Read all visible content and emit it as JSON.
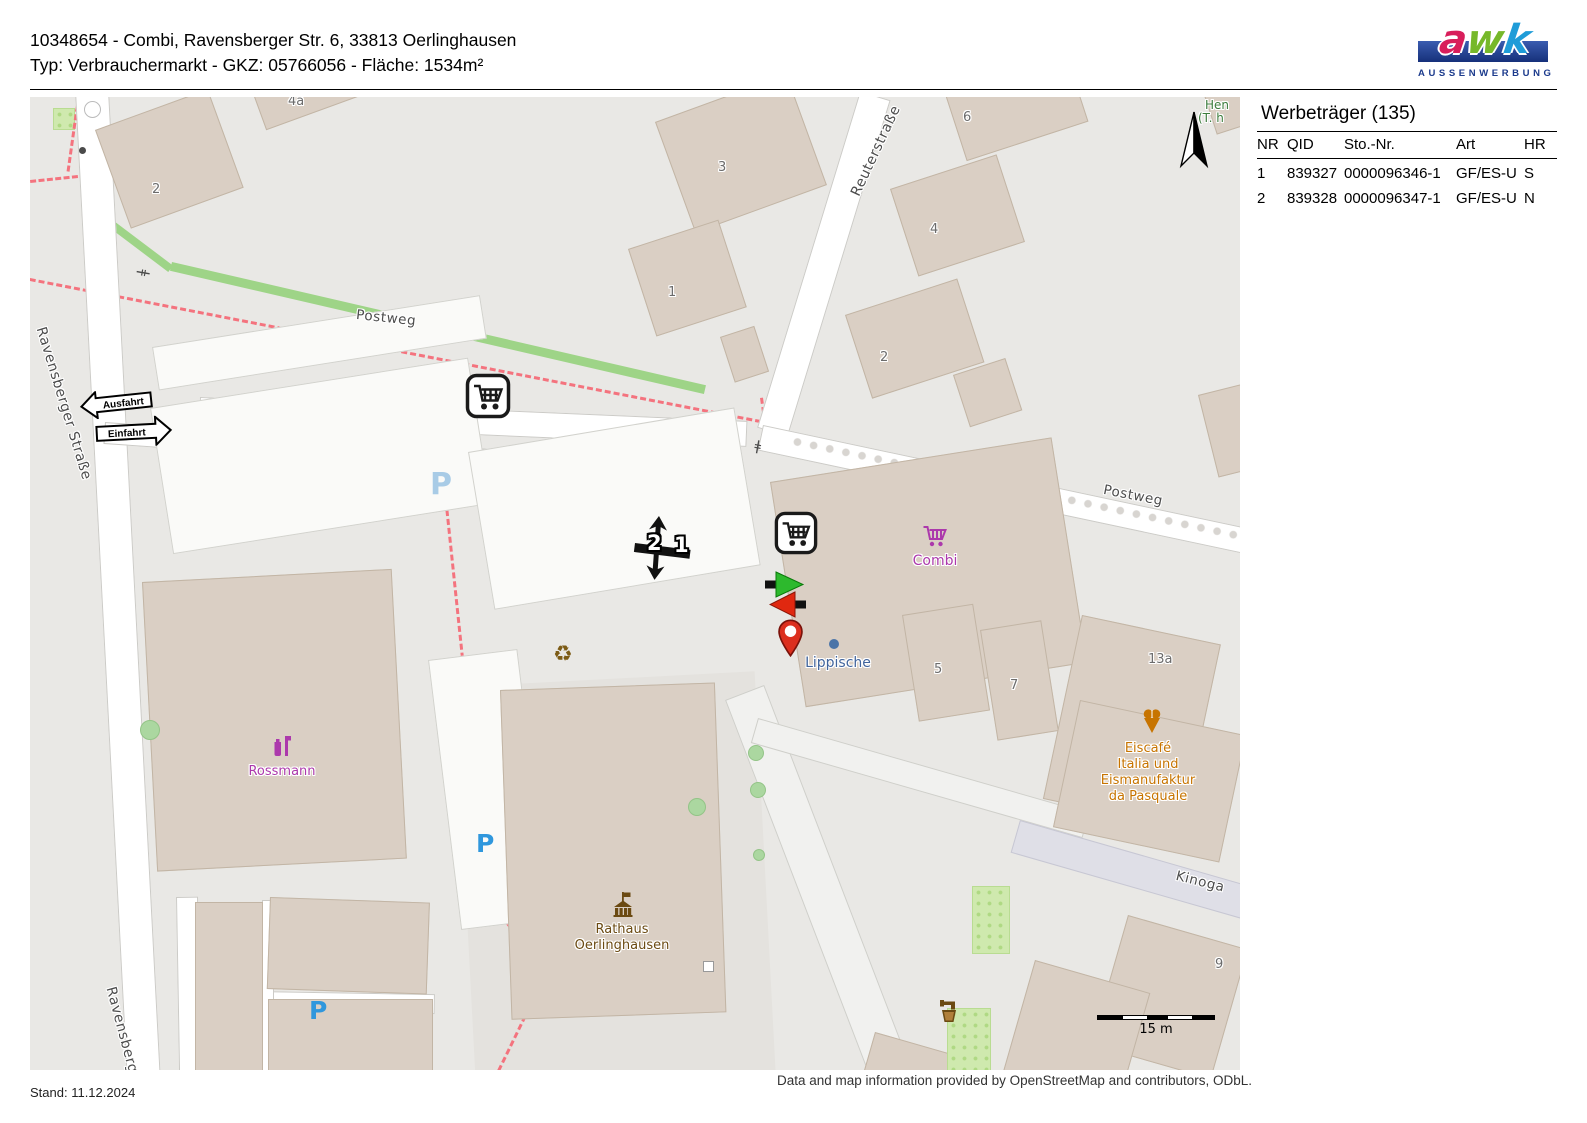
{
  "header": {
    "title": "10348654 - Combi, Ravensberger Str. 6, 33813 Oerlinghausen",
    "subtitle": "Typ: Verbrauchermarkt - GKZ: 05766056 - Fläche: 1534m²",
    "logo": {
      "letters": [
        "a",
        "w",
        "k"
      ],
      "subtext": "AUSSENWERBUNG"
    }
  },
  "panel": {
    "title": "Werbeträger (135)",
    "table": {
      "columns": [
        "NR",
        "QID",
        "Sto.-Nr.",
        "Art",
        "HR"
      ],
      "rows": [
        [
          "1",
          "839327",
          "0000096346-1",
          "GF/ES-U",
          "S"
        ],
        [
          "2",
          "839328",
          "0000096347-1",
          "GF/ES-U",
          "N"
        ]
      ]
    }
  },
  "map": {
    "street_labels": {
      "ravensberger": "Ravensberger Straße",
      "ravensberger_bottom": "Ravensberger Str",
      "postweg_top": "Postweg",
      "postweg_right": "Postweg",
      "reuterstrasse": "Reuterstraße",
      "kinogasse": "Kinoga"
    },
    "house_numbers": [
      "2",
      "4a",
      "3",
      "1",
      "6",
      "4",
      "2",
      "5",
      "7",
      "13a",
      "9"
    ],
    "pois": {
      "rossmann": "Rossmann",
      "combi": "Combi",
      "lippische": "Lippische",
      "rathaus": [
        "Rathaus",
        "Oerlinghausen"
      ],
      "eiscafe": [
        "Eiscafé",
        "Italia und",
        "Eismanufaktur",
        "da Pasquale"
      ]
    },
    "signs": {
      "ausfahrt": "Ausfahrt",
      "einfahrt": "Einfahrt"
    },
    "markers": {
      "site_1": "1",
      "site_2": "2"
    },
    "parking_letter": "P",
    "recycling_symbol": "♻",
    "clipped_green_labels": [
      "Hen",
      "(T. h"
    ],
    "scale_label": "15 m"
  },
  "footer": {
    "stand": "Stand: 11.12.2024",
    "attribution": "Data and map information provided by OpenStreetMap and contributors, ODbL."
  },
  "colors": {
    "shop_magenta": "#ac39ac",
    "civic_brown": "#6b4a12",
    "food_orange": "#c77400",
    "path_red": "#f4737e",
    "cycle_green": "#9ed487",
    "marker_green": "#2db92d",
    "marker_red": "#e02810"
  }
}
